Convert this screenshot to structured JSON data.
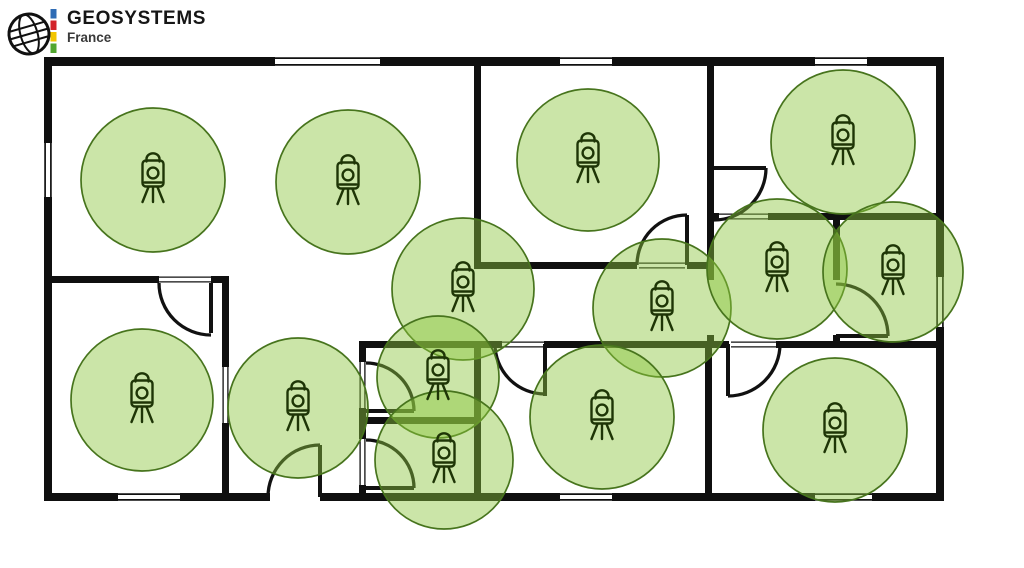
{
  "logo": {
    "brand": "GEOSYSTEMS",
    "region": "France",
    "bar_colors": [
      "#2f6cb5",
      "#d2232a",
      "#f2c500",
      "#52a62f"
    ]
  },
  "plan": {
    "background": "#ffffff",
    "wall_color": "#0f0f0f",
    "line_color": "#111111",
    "scan_style": {
      "fill": "#8CC63F",
      "fill_opacity": 0.45,
      "stroke": "#47741d",
      "stroke_width": 1.7,
      "icon_color": "#1e3506"
    },
    "walls": [
      [
        44,
        57,
        900,
        9
      ],
      [
        44,
        493,
        226,
        8
      ],
      [
        320,
        493,
        624,
        8
      ],
      [
        44,
        57,
        8,
        444
      ],
      [
        936,
        57,
        8,
        444
      ],
      [
        474,
        57,
        7,
        212
      ],
      [
        474,
        262,
        163,
        7
      ],
      [
        687,
        262,
        27,
        7
      ],
      [
        707,
        57,
        7,
        223
      ],
      [
        707,
        335,
        7,
        13
      ],
      [
        707,
        213,
        12,
        7
      ],
      [
        768,
        213,
        176,
        7
      ],
      [
        833,
        216,
        7,
        64
      ],
      [
        833,
        335,
        7,
        13
      ],
      [
        359,
        341,
        143,
        7
      ],
      [
        544,
        341,
        185,
        7
      ],
      [
        776,
        341,
        168,
        7
      ],
      [
        474,
        341,
        7,
        158
      ],
      [
        705,
        341,
        7,
        158
      ],
      [
        222,
        276,
        7,
        223
      ],
      [
        44,
        276,
        115,
        7
      ],
      [
        211,
        276,
        18,
        7
      ],
      [
        359,
        341,
        7,
        21
      ],
      [
        359,
        408,
        7,
        31
      ],
      [
        359,
        485,
        7,
        14
      ],
      [
        359,
        417,
        122,
        7
      ]
    ],
    "windows": [
      [
        275,
        57,
        105,
        9
      ],
      [
        560,
        57,
        52,
        9
      ],
      [
        815,
        57,
        52,
        9
      ],
      [
        44,
        143,
        8,
        54
      ],
      [
        936,
        277,
        8,
        50
      ],
      [
        118,
        493,
        62,
        8
      ],
      [
        560,
        493,
        52,
        8
      ],
      [
        815,
        493,
        57,
        8
      ]
    ],
    "sills": [
      [
        639,
        262,
        46,
        7
      ],
      [
        719,
        213,
        49,
        7
      ],
      [
        731,
        341,
        45,
        7
      ],
      [
        502,
        341,
        42,
        7
      ],
      [
        159,
        276,
        52,
        7
      ],
      [
        222,
        367,
        7,
        56
      ],
      [
        359,
        362,
        7,
        46
      ],
      [
        359,
        439,
        7,
        46
      ]
    ],
    "doors": [
      {
        "cx": 211,
        "cy": 283,
        "r": 52,
        "start": 90,
        "end": 180,
        "leaf": [
          211,
          283,
          211,
          333
        ]
      },
      {
        "cx": 320,
        "cy": 497,
        "r": 52,
        "start": 270,
        "end": 180,
        "leaf": [
          320,
          445,
          320,
          497
        ]
      },
      {
        "cx": 366,
        "cy": 411,
        "r": 48,
        "start": 0,
        "end": 270,
        "leaf": [
          366,
          411,
          414,
          411
        ]
      },
      {
        "cx": 366,
        "cy": 488,
        "r": 48,
        "start": 0,
        "end": 270,
        "leaf": [
          366,
          488,
          414,
          488
        ]
      },
      {
        "cx": 687,
        "cy": 265,
        "r": 50,
        "start": 270,
        "end": 180,
        "leaf": [
          687,
          215,
          687,
          265
        ]
      },
      {
        "cx": 714,
        "cy": 168,
        "r": 52,
        "start": 0,
        "end": 90,
        "leaf": [
          714,
          168,
          766,
          168
        ]
      },
      {
        "cx": 728,
        "cy": 344,
        "r": 52,
        "start": 90,
        "end": 0,
        "leaf": [
          728,
          344,
          728,
          396
        ]
      },
      {
        "cx": 836,
        "cy": 336,
        "r": 52,
        "start": 270,
        "end": 0,
        "leaf": [
          836,
          336,
          888,
          336
        ]
      },
      {
        "cx": 545,
        "cy": 344,
        "r": 50,
        "start": 90,
        "end": 180,
        "leaf": [
          545,
          344,
          545,
          396
        ]
      }
    ],
    "scan_positions": [
      {
        "x": 153,
        "y": 180,
        "r": 72
      },
      {
        "x": 348,
        "y": 182,
        "r": 72
      },
      {
        "x": 588,
        "y": 160,
        "r": 71
      },
      {
        "x": 843,
        "y": 142,
        "r": 72
      },
      {
        "x": 463,
        "y": 289,
        "r": 71
      },
      {
        "x": 662,
        "y": 308,
        "r": 69
      },
      {
        "x": 777,
        "y": 269,
        "r": 70
      },
      {
        "x": 893,
        "y": 272,
        "r": 70
      },
      {
        "x": 142,
        "y": 400,
        "r": 71
      },
      {
        "x": 298,
        "y": 408,
        "r": 70
      },
      {
        "x": 438,
        "y": 377,
        "r": 61
      },
      {
        "x": 444,
        "y": 460,
        "r": 69
      },
      {
        "x": 602,
        "y": 417,
        "r": 72
      },
      {
        "x": 835,
        "y": 430,
        "r": 72
      }
    ]
  }
}
